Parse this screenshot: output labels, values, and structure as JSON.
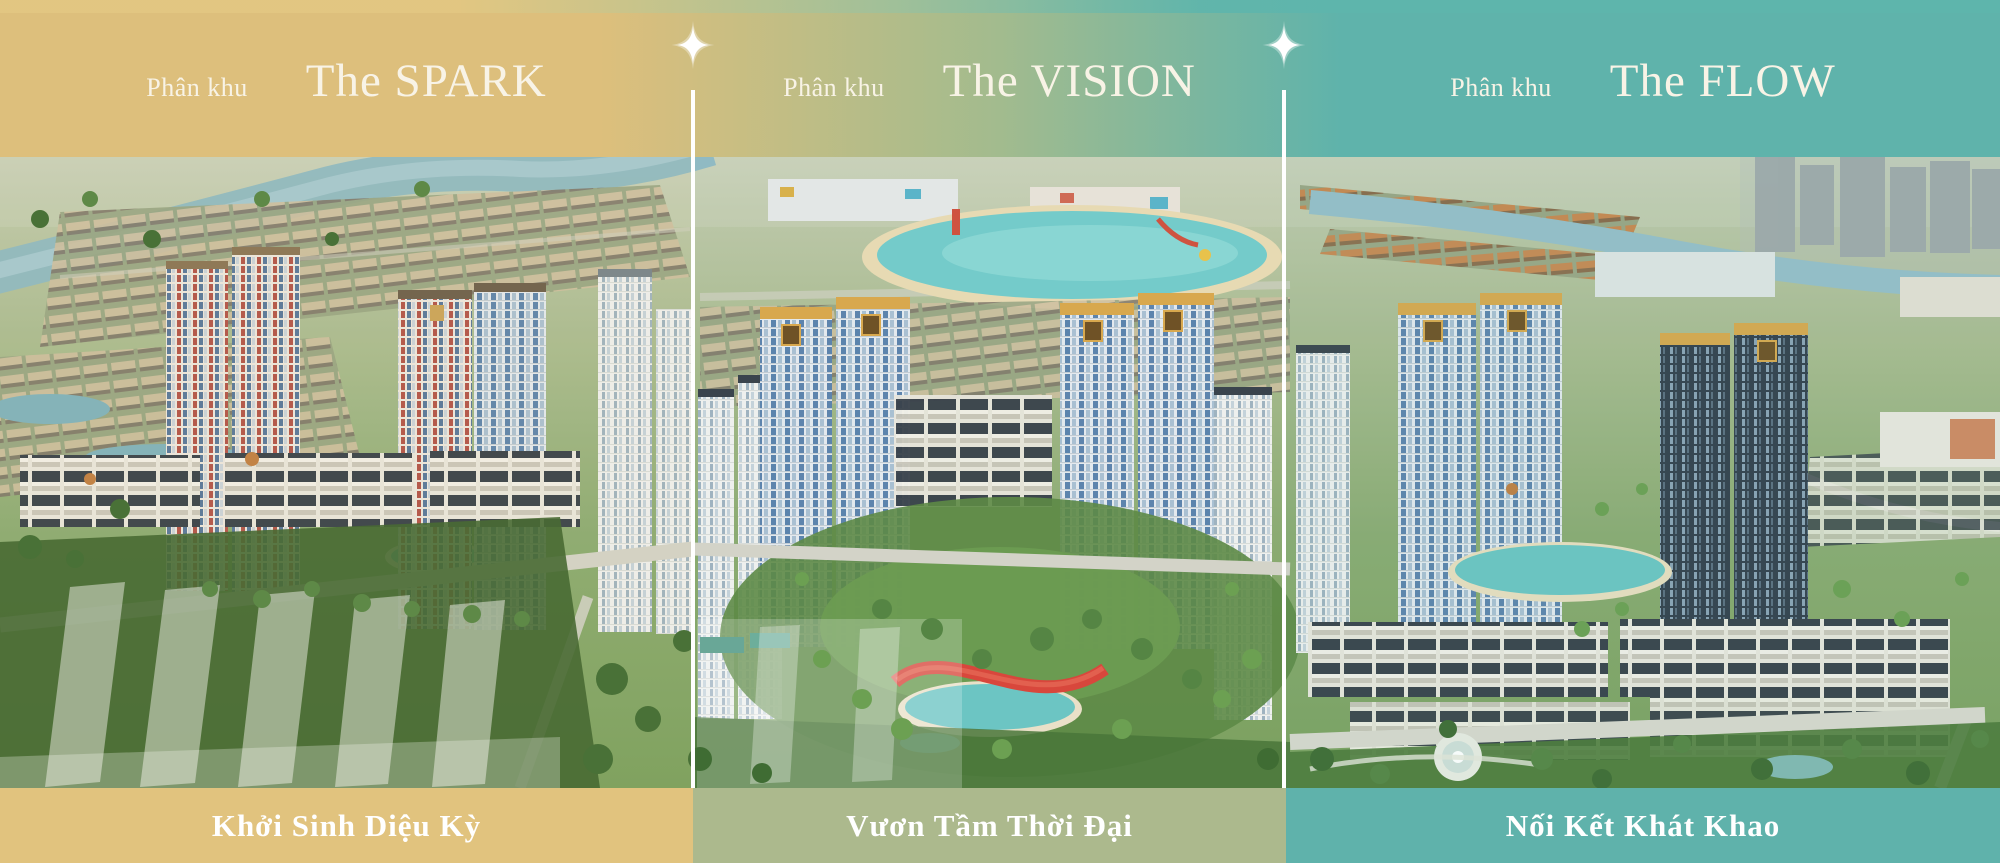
{
  "photo": {
    "alt": "Aerial masterplan render of a township: high-rise apartment clusters, low-rise row houses, lagoon water park, canals, parks and greenery, split into three sections by white divider lines"
  },
  "colors": {
    "gold": "#ddbf7c",
    "teal": "#5fb3ab",
    "footer_gold": "#e1c37e",
    "footer_sage": "#acb98d",
    "footer_teal": "#5fb2ab",
    "divider": "#ffffff",
    "text": "#f8f3e6"
  },
  "decor": {
    "sparkle_icon": "four-point-star",
    "divider_style": "vertical-white-line"
  },
  "panels": [
    {
      "label": "Phân khu",
      "title": "The SPARK",
      "tagline": "Khởi Sinh Diệu Kỳ"
    },
    {
      "label": "Phân khu",
      "title": "The VISION",
      "tagline": "Vươn Tầm Thời Đại"
    },
    {
      "label": "Phân khu",
      "title": "The FLOW",
      "tagline": "Nối Kết Khát Khao"
    }
  ]
}
